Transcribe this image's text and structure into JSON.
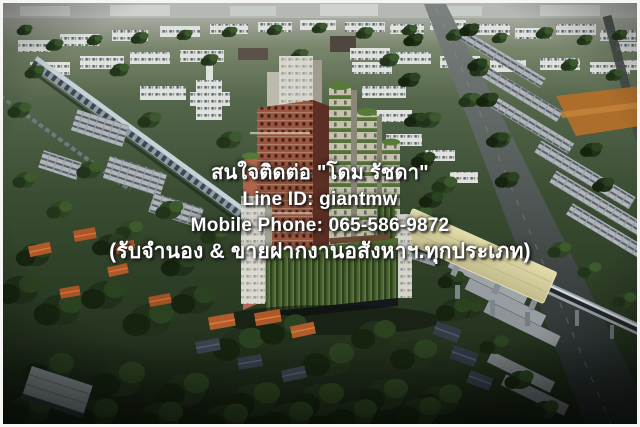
{
  "overlay": {
    "lines": [
      "สนใจติดต่อ \"โดม รัชดา\"",
      "Line ID: giantmw",
      "Mobile Phone: 065-586-9872",
      "(รับจำนอง & ขายฝากงานอสังหาฯ.ทุกประเภท)"
    ],
    "contact_name": "โดม รัชดา",
    "line_id": "giantmw",
    "mobile_phone": "065-586-9872",
    "text_color": "#ffffff",
    "shadow_color": "#1e1e1e"
  },
  "scene": {
    "type": "aerial-3d-render",
    "subject": "high-rise condominium tower among low-rise houses, elevated rail lines and roads",
    "colors": {
      "tower_brick": "#9a5640",
      "tower_cream": "#d2cec0",
      "podium_green": "#47602e",
      "station_roof": "#d8d2a1",
      "viaduct": "#b7c2ca",
      "tree_dark": "#22351a",
      "tree_mid": "#2e4424",
      "roof_orange": "#b05a2b",
      "road": "#4a504f",
      "horizon_haze": "#b5b8b3",
      "border": "#f5f5f3"
    }
  }
}
